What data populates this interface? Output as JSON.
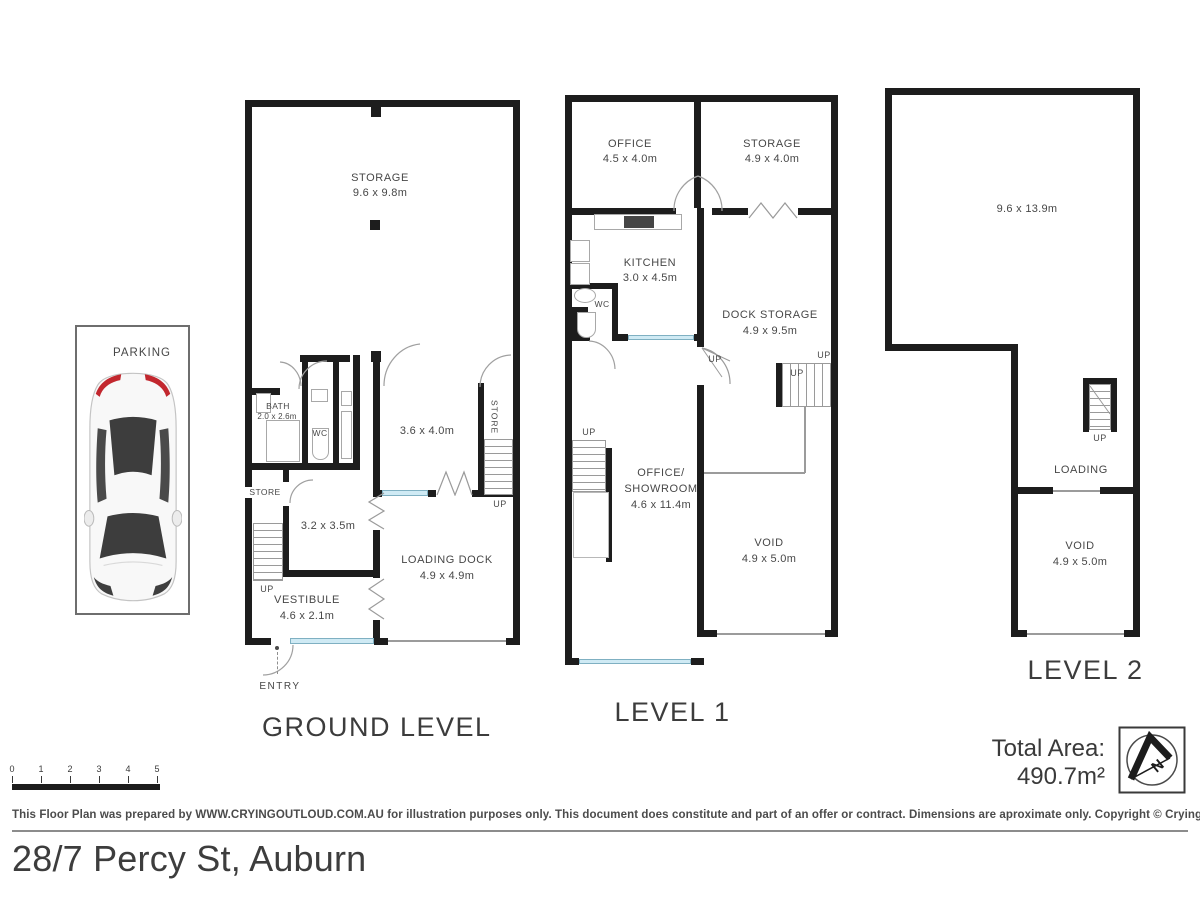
{
  "shared": {
    "up_label": "UP"
  },
  "parking": {
    "label": "PARKING"
  },
  "ground": {
    "title": "GROUND LEVEL",
    "entry_label": "ENTRY",
    "rooms": {
      "storage": {
        "name": "STORAGE",
        "dims": "9.6 x 9.8m"
      },
      "bath": {
        "name": "BATH",
        "dims": "2.0 x 2.6m"
      },
      "wc": {
        "name": "WC"
      },
      "room_a": {
        "dims": "3.6 x 4.0m"
      },
      "store_right": {
        "name": "STORE"
      },
      "store_left": {
        "name": "STORE"
      },
      "room_b": {
        "dims": "3.2 x 3.5m"
      },
      "loading_dock": {
        "name": "LOADING DOCK",
        "dims": "4.9 x 4.9m"
      },
      "vestibule": {
        "name": "VESTIBULE",
        "dims": "4.6 x 2.1m"
      }
    }
  },
  "level1": {
    "title": "LEVEL 1",
    "rooms": {
      "office": {
        "name": "OFFICE",
        "dims": "4.5 x 4.0m"
      },
      "storage": {
        "name": "STORAGE",
        "dims": "4.9 x 4.0m"
      },
      "kitchen": {
        "name": "KITCHEN",
        "dims": "3.0 x 4.5m"
      },
      "wc": {
        "name": "WC"
      },
      "dock_storage": {
        "name": "DOCK STORAGE",
        "dims": "4.9 x 9.5m"
      },
      "office_showroom": {
        "name_line1": "OFFICE/",
        "name_line2": "SHOWROOM",
        "dims": "4.6 x 11.4m"
      },
      "void": {
        "name": "VOID",
        "dims": "4.9 x 5.0m"
      }
    }
  },
  "level2": {
    "title": "LEVEL 2",
    "rooms": {
      "main": {
        "dims": "9.6 x 13.9m"
      },
      "loading": {
        "name": "LOADING"
      },
      "void": {
        "name": "VOID",
        "dims": "4.9 x 5.0m"
      }
    }
  },
  "footer": {
    "total_area": "Total Area: 490.7m²",
    "compass_n": "N",
    "scale_ticks": [
      "0",
      "1",
      "2",
      "3",
      "4",
      "5"
    ],
    "disclaimer": "This Floor Plan was prepared by WWW.CRYINGOUTLOUD.COM.AU for illustration purposes only. This document does constitute and part of an offer or contract. Dimensions are aproximate only. Copyright © Crying Out Loud. All Rights Reserved.",
    "address": "28/7 Percy St, Auburn"
  }
}
